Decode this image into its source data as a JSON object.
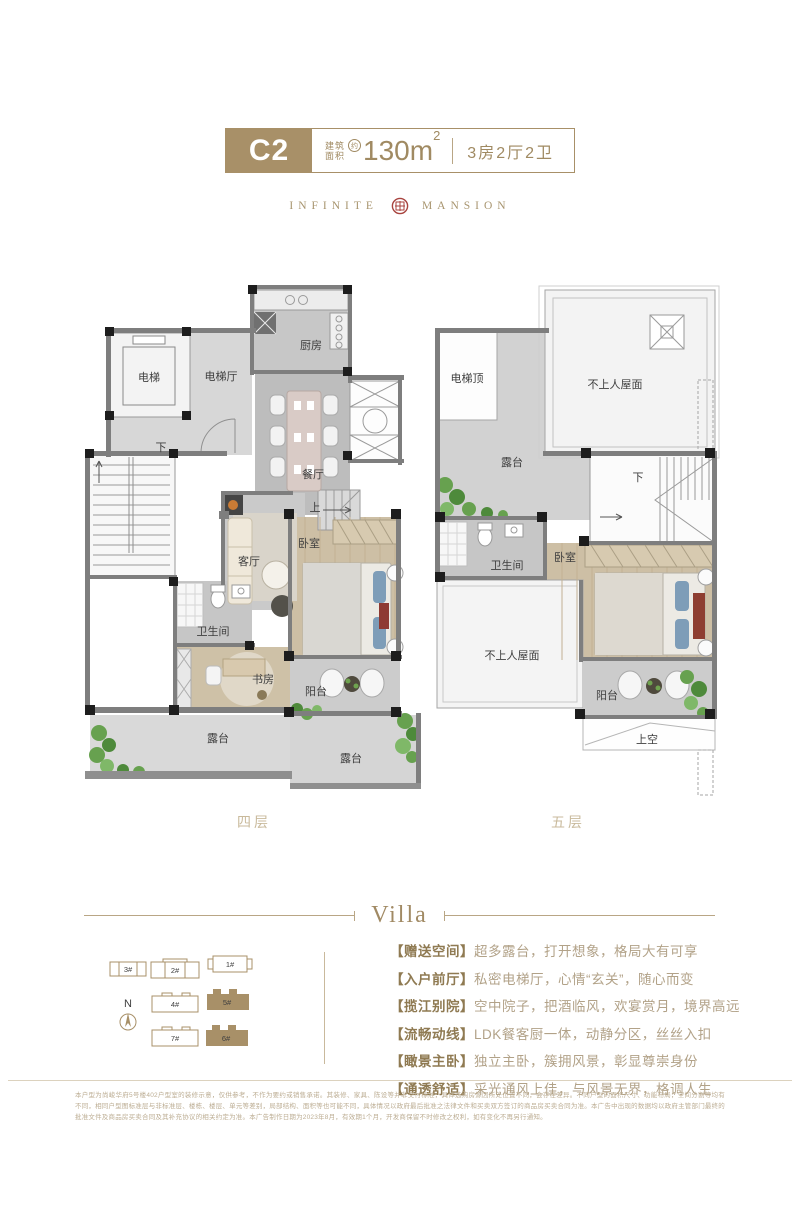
{
  "colors": {
    "accent_gold": "#A89068",
    "seal_red": "#A8433E"
  },
  "header": {
    "unit_code": "C2",
    "area_label_top": "建筑",
    "area_label_bottom": "面积",
    "approx_mark": "约",
    "area_value": "130m",
    "area_sup": "2",
    "layout_text": "3房2厅2卫"
  },
  "brand": {
    "left_word": "INFINITE",
    "right_word": "MANSION"
  },
  "floors": {
    "left": {
      "caption": "四层",
      "rooms": {
        "elevator": "电梯",
        "elevator_hall": "电梯厅",
        "kitchen": "厨房",
        "dining": "餐厅",
        "down": "下",
        "up": "上",
        "living": "客厅",
        "bedroom": "卧室",
        "bath": "卫生间",
        "study": "书房",
        "balcony": "阳台",
        "terrace_left": "露台",
        "terrace_right": "露台"
      }
    },
    "right": {
      "caption": "五层",
      "rooms": {
        "elevator_top": "电梯顶",
        "roof_upper": "不上人屋面",
        "terrace": "露台",
        "down": "下",
        "bath": "卫生间",
        "bedroom": "卧室",
        "roof_lower": "不上人屋面",
        "balcony": "阳台",
        "void_above": "上空"
      }
    }
  },
  "villa_section": {
    "title": "Villa"
  },
  "siteplan": {
    "north_label": "N",
    "buildings": [
      {
        "id": "3#"
      },
      {
        "id": "2#"
      },
      {
        "id": "1#"
      },
      {
        "id": "4#"
      },
      {
        "id": "5#"
      },
      {
        "id": "7#"
      },
      {
        "id": "6#"
      }
    ]
  },
  "features": [
    {
      "label": "【赠送空间】",
      "desc": "超多露台，打开想象，格局大有可享"
    },
    {
      "label": "【入户前厅】",
      "desc": "私密电梯厅，心情“玄关”，随心而变"
    },
    {
      "label": "【揽江别院】",
      "desc": "空中院子，把酒临风，欢宴赏月，境界高远"
    },
    {
      "label": "【流畅动线】",
      "desc": "LDK餐客厨一体，动静分区，丝丝入扣"
    },
    {
      "label": "【瞰景主卧】",
      "desc": "独立主卧，簇拥风景，彰显尊崇身份"
    },
    {
      "label": "【通透舒适】",
      "desc": "采光通风上佳，与风景无界，格调人生"
    }
  ],
  "disclaimer": "本户型为尚峻华府5号楼402户型室的装修示意，仅供参考，不作为要约或销售承诺。其装修、家具、陈设等并非交付标准，具体选购房源因所处位置不同，会存在差异。不同户型的面积尺寸、功能布局，空间分割等均有不同，相同户型图标准层与非标准层、楼栋、楼层、单元等差别，局部结构、面积等也可能不同，具体情况以政府最后批准之法律文件和买卖双方签订的商品房买卖合同为准。本广告中出现的数据均以政府主管部门最终的批准文件及商品房买卖合同及其补充协议的相关约定为准。本广告制作日期为2023年8月，有效期1个月，开发商保留不时修改之权利，如有变化不再另行通知。"
}
